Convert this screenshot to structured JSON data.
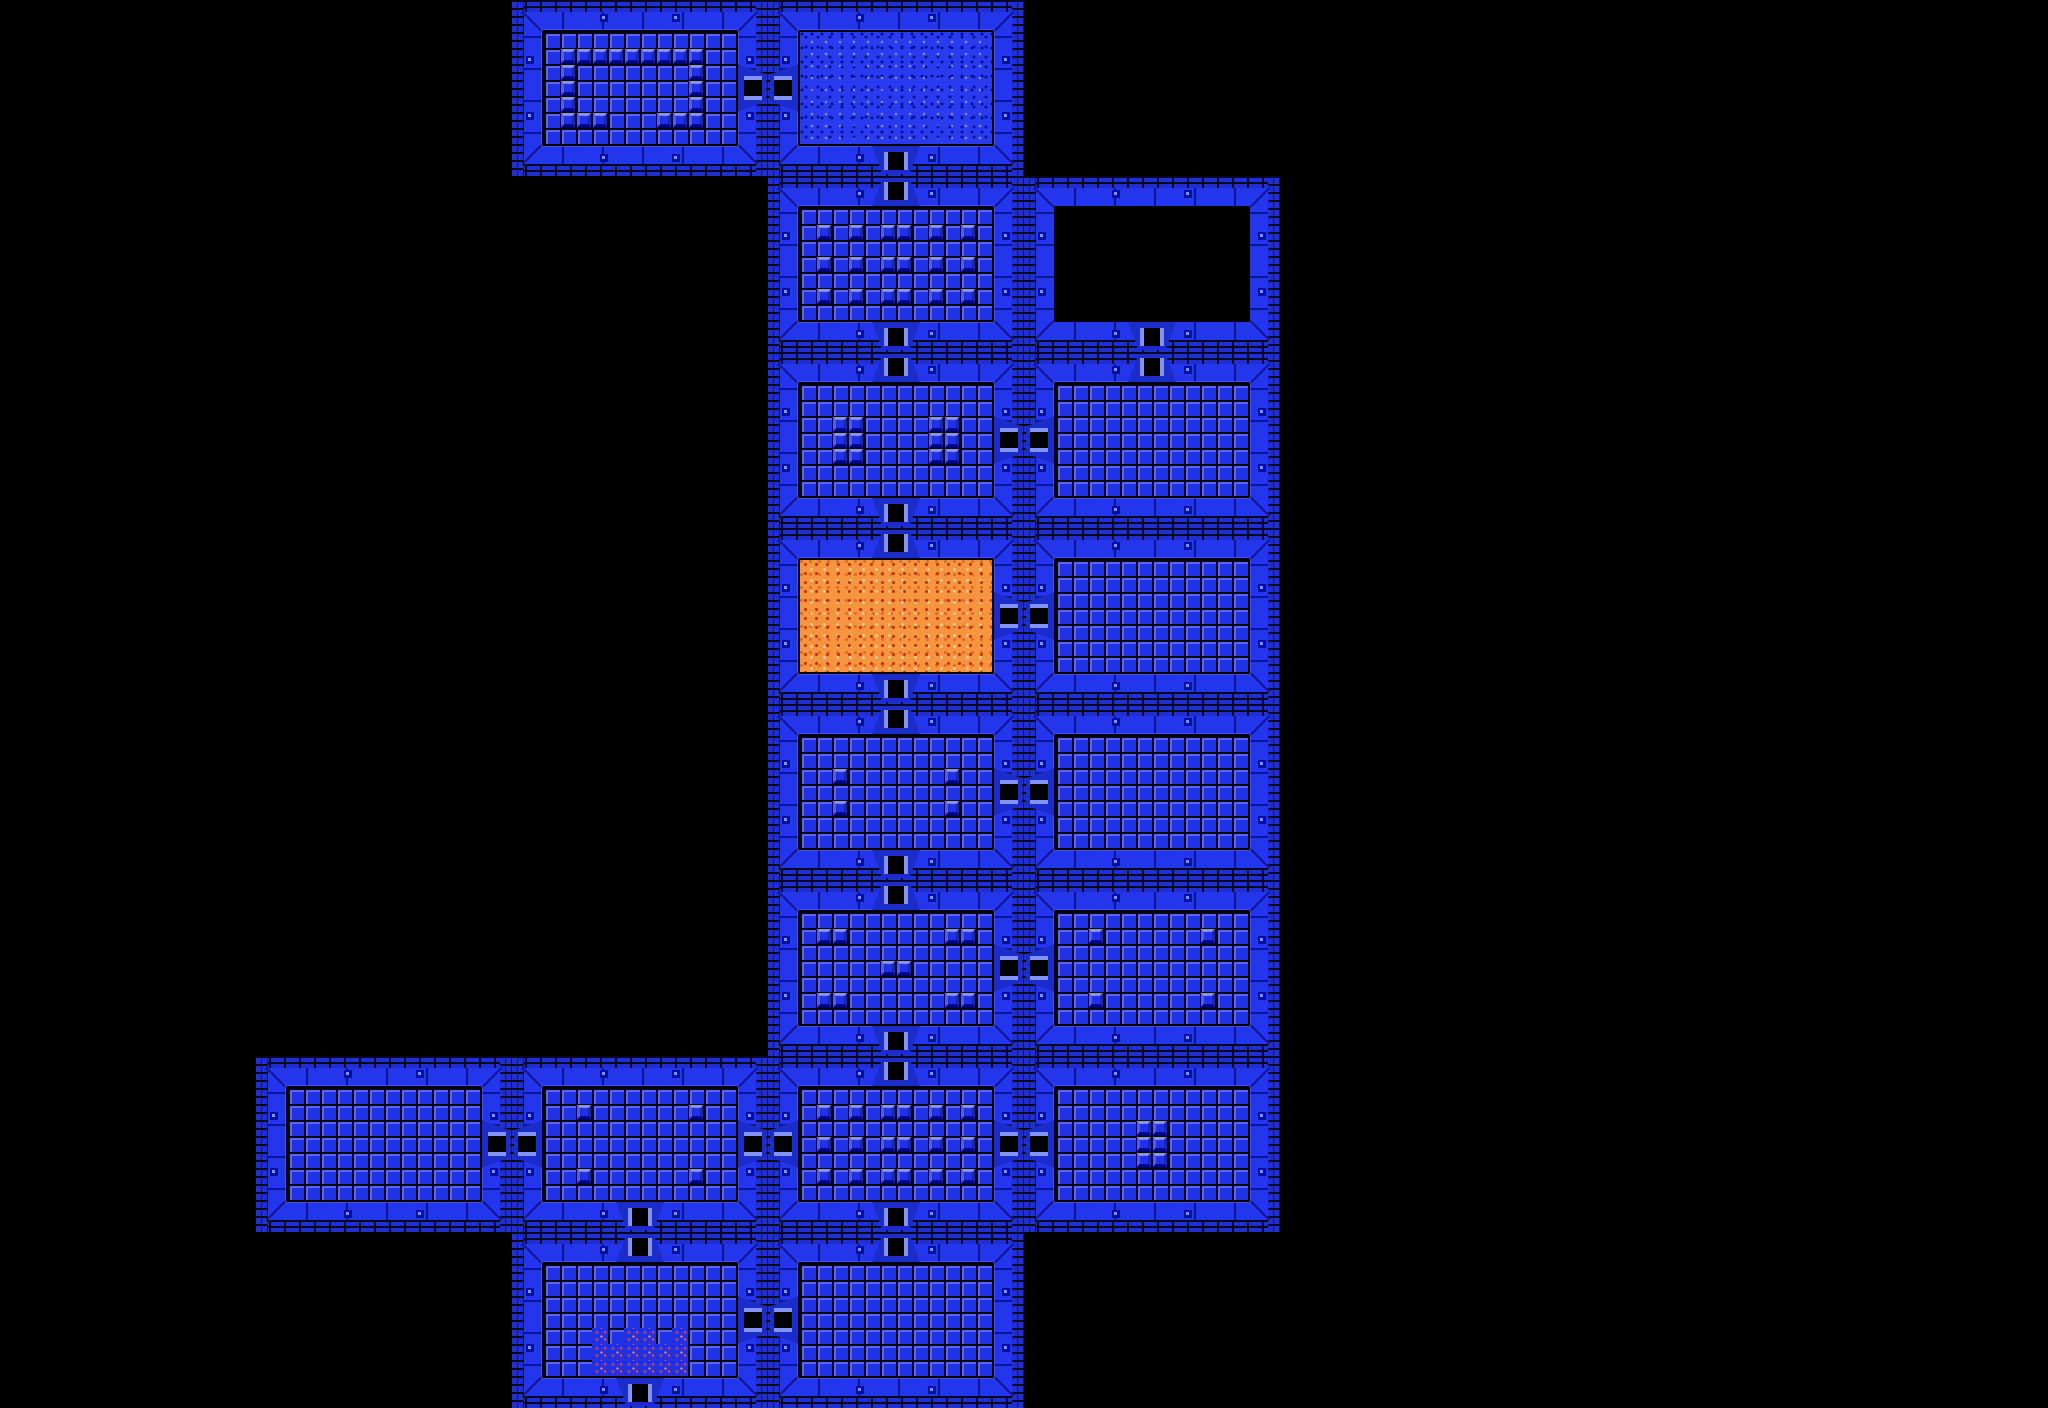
{
  "map": {
    "grid": {
      "cols": 8,
      "rows": 8,
      "room_width": 256,
      "room_height": 176,
      "room_count": 18,
      "interior_cols": 12,
      "interior_rows": 7,
      "tile_size": 16
    },
    "palette": {
      "background": "#000000",
      "wall_blue": "#2436EC",
      "brick_blue": "#1F2FD6",
      "mortar": "#000820",
      "joint": "#0A1690",
      "navy": "#0010A0",
      "tile_blue": "#2132E4",
      "tile_line": "#000618",
      "tile_highlight": "#5866F4",
      "block_light": "#8291FC",
      "block_mid_light": "#4D5CF4",
      "block_mid_dark": "#1523C4",
      "block_dark": "#000A86",
      "door_alcove": "#1B2CCB",
      "door_post": "#8291FC",
      "door_opening": "#000000",
      "sand_blue_base": "#2A3AEE",
      "sand_blue_dot_dark": "#000D90",
      "sand_blue_dot_light": "#8291FC",
      "sand_orange_base": "#F6953F",
      "sand_orange_dot_red": "#C62D0B",
      "sand_orange_dot_dark": "#E06B1F",
      "sand_orange_dot_light": "#FCD9A0",
      "entrance_dot_red": "#E04040",
      "entrance_dot_pink": "#F090A0"
    },
    "rooms": [
      {
        "row": 0,
        "col": 2,
        "floor": "tiles",
        "doors": [
          "e"
        ],
        "blocks": [
          [
            1,
            1
          ],
          [
            1,
            2
          ],
          [
            1,
            3
          ],
          [
            1,
            4
          ],
          [
            1,
            5
          ],
          [
            1,
            6
          ],
          [
            1,
            7
          ],
          [
            1,
            8
          ],
          [
            1,
            9
          ],
          [
            2,
            1
          ],
          [
            2,
            9
          ],
          [
            3,
            1
          ],
          [
            3,
            9
          ],
          [
            4,
            1
          ],
          [
            4,
            9
          ],
          [
            5,
            1
          ],
          [
            5,
            2
          ],
          [
            5,
            3
          ],
          [
            5,
            7
          ],
          [
            5,
            8
          ],
          [
            5,
            9
          ]
        ]
      },
      {
        "row": 0,
        "col": 3,
        "floor": "sand_blue",
        "doors": [
          "w",
          "s"
        ],
        "blocks": []
      },
      {
        "row": 1,
        "col": 3,
        "floor": "tiles",
        "doors": [
          "n",
          "s"
        ],
        "blocks": [
          [
            1,
            1
          ],
          [
            1,
            3
          ],
          [
            1,
            5
          ],
          [
            1,
            6
          ],
          [
            1,
            8
          ],
          [
            1,
            10
          ],
          [
            3,
            1
          ],
          [
            3,
            3
          ],
          [
            3,
            5
          ],
          [
            3,
            6
          ],
          [
            3,
            8
          ],
          [
            3,
            10
          ],
          [
            5,
            1
          ],
          [
            5,
            3
          ],
          [
            5,
            5
          ],
          [
            5,
            6
          ],
          [
            5,
            8
          ],
          [
            5,
            10
          ]
        ]
      },
      {
        "row": 1,
        "col": 4,
        "floor": "dark",
        "doors": [
          "s"
        ],
        "blocks": []
      },
      {
        "row": 2,
        "col": 3,
        "floor": "tiles",
        "doors": [
          "n",
          "s",
          "e"
        ],
        "blocks": [
          [
            2,
            2
          ],
          [
            2,
            3
          ],
          [
            3,
            2
          ],
          [
            3,
            3
          ],
          [
            4,
            2
          ],
          [
            4,
            3
          ],
          [
            2,
            8
          ],
          [
            2,
            9
          ],
          [
            3,
            8
          ],
          [
            3,
            9
          ],
          [
            4,
            8
          ],
          [
            4,
            9
          ]
        ]
      },
      {
        "row": 2,
        "col": 4,
        "floor": "tiles",
        "doors": [
          "n",
          "w"
        ],
        "blocks": []
      },
      {
        "row": 3,
        "col": 3,
        "floor": "sand_orange",
        "doors": [
          "n",
          "s",
          "e"
        ],
        "blocks": []
      },
      {
        "row": 3,
        "col": 4,
        "floor": "tiles",
        "doors": [
          "w"
        ],
        "blocks": []
      },
      {
        "row": 4,
        "col": 3,
        "floor": "tiles",
        "doors": [
          "n",
          "s",
          "e"
        ],
        "blocks": [
          [
            2,
            2
          ],
          [
            2,
            9
          ],
          [
            4,
            2
          ],
          [
            4,
            9
          ]
        ]
      },
      {
        "row": 4,
        "col": 4,
        "floor": "tiles",
        "doors": [
          "w"
        ],
        "blocks": []
      },
      {
        "row": 5,
        "col": 3,
        "floor": "tiles",
        "doors": [
          "n",
          "s",
          "e"
        ],
        "blocks": [
          [
            1,
            1
          ],
          [
            1,
            2
          ],
          [
            1,
            9
          ],
          [
            1,
            10
          ],
          [
            3,
            5
          ],
          [
            3,
            6
          ],
          [
            5,
            1
          ],
          [
            5,
            2
          ],
          [
            5,
            9
          ],
          [
            5,
            10
          ]
        ]
      },
      {
        "row": 5,
        "col": 4,
        "floor": "tiles",
        "doors": [
          "w"
        ],
        "blocks": [
          [
            1,
            2
          ],
          [
            1,
            9
          ],
          [
            5,
            2
          ],
          [
            5,
            9
          ]
        ]
      },
      {
        "row": 6,
        "col": 1,
        "floor": "tiles",
        "doors": [
          "e"
        ],
        "blocks": []
      },
      {
        "row": 6,
        "col": 2,
        "floor": "tiles",
        "doors": [
          "w",
          "e",
          "s"
        ],
        "blocks": [
          [
            1,
            2
          ],
          [
            1,
            9
          ],
          [
            5,
            2
          ],
          [
            5,
            9
          ]
        ]
      },
      {
        "row": 6,
        "col": 3,
        "floor": "tiles",
        "doors": [
          "n",
          "s",
          "w",
          "e"
        ],
        "blocks": [
          [
            1,
            1
          ],
          [
            1,
            3
          ],
          [
            1,
            5
          ],
          [
            1,
            6
          ],
          [
            1,
            8
          ],
          [
            1,
            10
          ],
          [
            3,
            1
          ],
          [
            3,
            3
          ],
          [
            3,
            5
          ],
          [
            3,
            6
          ],
          [
            3,
            8
          ],
          [
            3,
            10
          ],
          [
            5,
            1
          ],
          [
            5,
            3
          ],
          [
            5,
            5
          ],
          [
            5,
            6
          ],
          [
            5,
            8
          ],
          [
            5,
            10
          ]
        ]
      },
      {
        "row": 6,
        "col": 4,
        "floor": "tiles",
        "doors": [
          "w"
        ],
        "blocks": [
          [
            2,
            5
          ],
          [
            2,
            6
          ],
          [
            3,
            5
          ],
          [
            3,
            6
          ],
          [
            4,
            5
          ],
          [
            4,
            6
          ]
        ]
      },
      {
        "row": 7,
        "col": 2,
        "floor": "tiles",
        "doors": [
          "n",
          "e",
          "s"
        ],
        "blocks": [],
        "sand_tiles": [
          [
            4,
            3
          ],
          [
            4,
            5
          ],
          [
            4,
            6
          ],
          [
            4,
            8
          ],
          [
            5,
            3
          ],
          [
            5,
            4
          ],
          [
            5,
            5
          ],
          [
            5,
            6
          ],
          [
            5,
            7
          ],
          [
            5,
            8
          ],
          [
            6,
            3
          ],
          [
            6,
            4
          ],
          [
            6,
            5
          ],
          [
            6,
            6
          ],
          [
            6,
            7
          ],
          [
            6,
            8
          ]
        ]
      },
      {
        "row": 7,
        "col": 3,
        "floor": "tiles",
        "doors": [
          "n",
          "w"
        ],
        "blocks": []
      }
    ]
  }
}
